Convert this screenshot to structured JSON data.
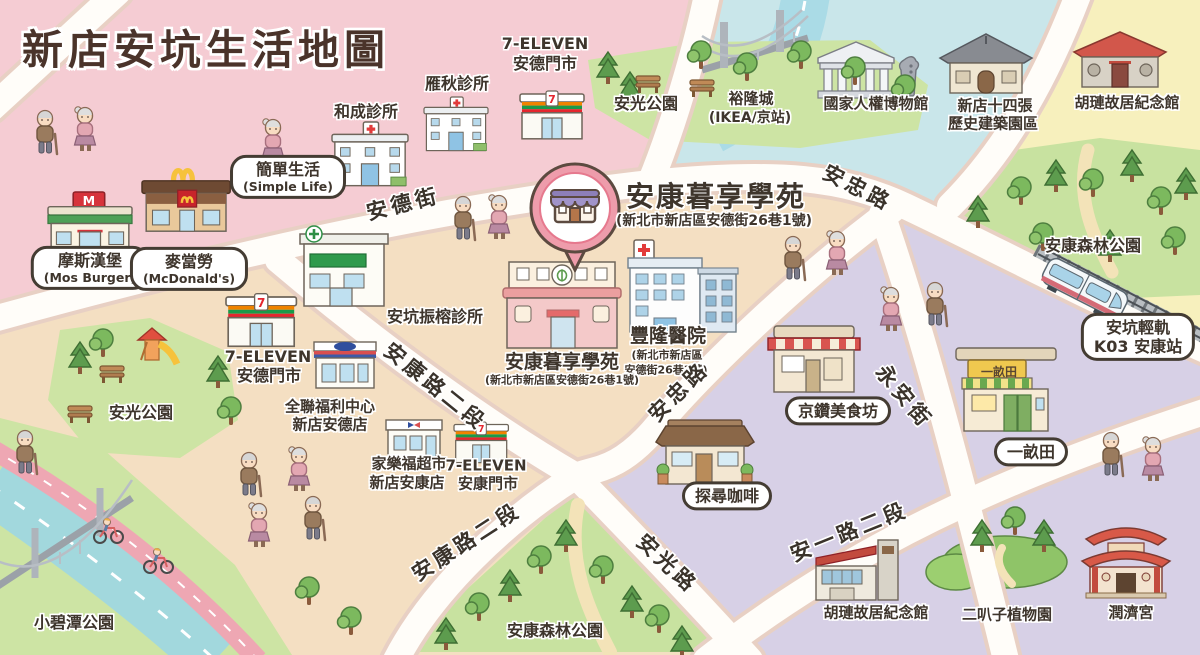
{
  "title": "新店安坑生活地圖",
  "highlight": {
    "name": "安康暮享學苑",
    "address": "(新北市新店區安德街26巷1號)"
  },
  "places": {
    "simple_life_zh": "簡單生活",
    "simple_life_en": "(Simple Life)",
    "mos_zh": "摩斯漢堡",
    "mos_en": "(Mos Burger)",
    "mcd_zh": "麥當勞",
    "mcd_en": "(McDonald's)",
    "hecheng_clinic": "和成診所",
    "yanqiu_clinic": "雁秋診所",
    "seven_brand": "7-ELEVEN",
    "seven_ande": "安德門市",
    "seven_ankang": "安康門市",
    "anguang_park": "安光公園",
    "yulon_zh": "裕隆城",
    "yulon_en": "(IKEA/京站)",
    "human_rights_museum": "國家人權博物館",
    "shisizhang_1": "新店十四張",
    "shisizhang_2": "歷史建築園區",
    "hulian_memorial": "胡璉故居紀念館",
    "ankang_forest_park": "安康森林公園",
    "lightrail_1": "安坑輕軌",
    "lightrail_2": "K03 安康站",
    "fenglong_hospital": "豐隆醫院",
    "fenglong_addr_1": "(新北市新店區",
    "fenglong_addr_2": "安德街26巷3號)",
    "ankeng_clinic": "安坑振榕診所",
    "pxmart_1": "全聯福利中心",
    "pxmart_2": "新店安德店",
    "carrefour_1": "家樂福超市",
    "carrefour_2": "新店安康店",
    "jingzuan": "京鑽美食坊",
    "yimutian": "一畝田",
    "tanxun_cafe": "探尋咖啡",
    "xiaobitan_park": "小碧潭公園",
    "erbazi_garden": "二叭子植物園",
    "runji_temple": "潤濟宮"
  },
  "roads": {
    "ande_st": "安德街",
    "anzhong_rd": "安忠路",
    "ankang_rd_2": "安康路二段",
    "yongan_st": "永安街",
    "anguang_rd": "安光路",
    "anyi_rd_2": "安一路二段"
  },
  "logos": {
    "seven": "7",
    "mos": "M"
  },
  "palette": {
    "zone_pink": "#f5ccd3",
    "zone_peach": "#f4dfc2",
    "zone_blue": "#c9e6ea",
    "zone_yellow": "#f7f0bd",
    "zone_purple": "#d7d0e6",
    "park_green": "#cde4a4",
    "road_white": "#fffdf9",
    "river_blue": "#a2d8dd",
    "bike_path_pink": "#eea7b3",
    "pin_pink": "#ee9cab",
    "title_brown": "#4a332a"
  }
}
